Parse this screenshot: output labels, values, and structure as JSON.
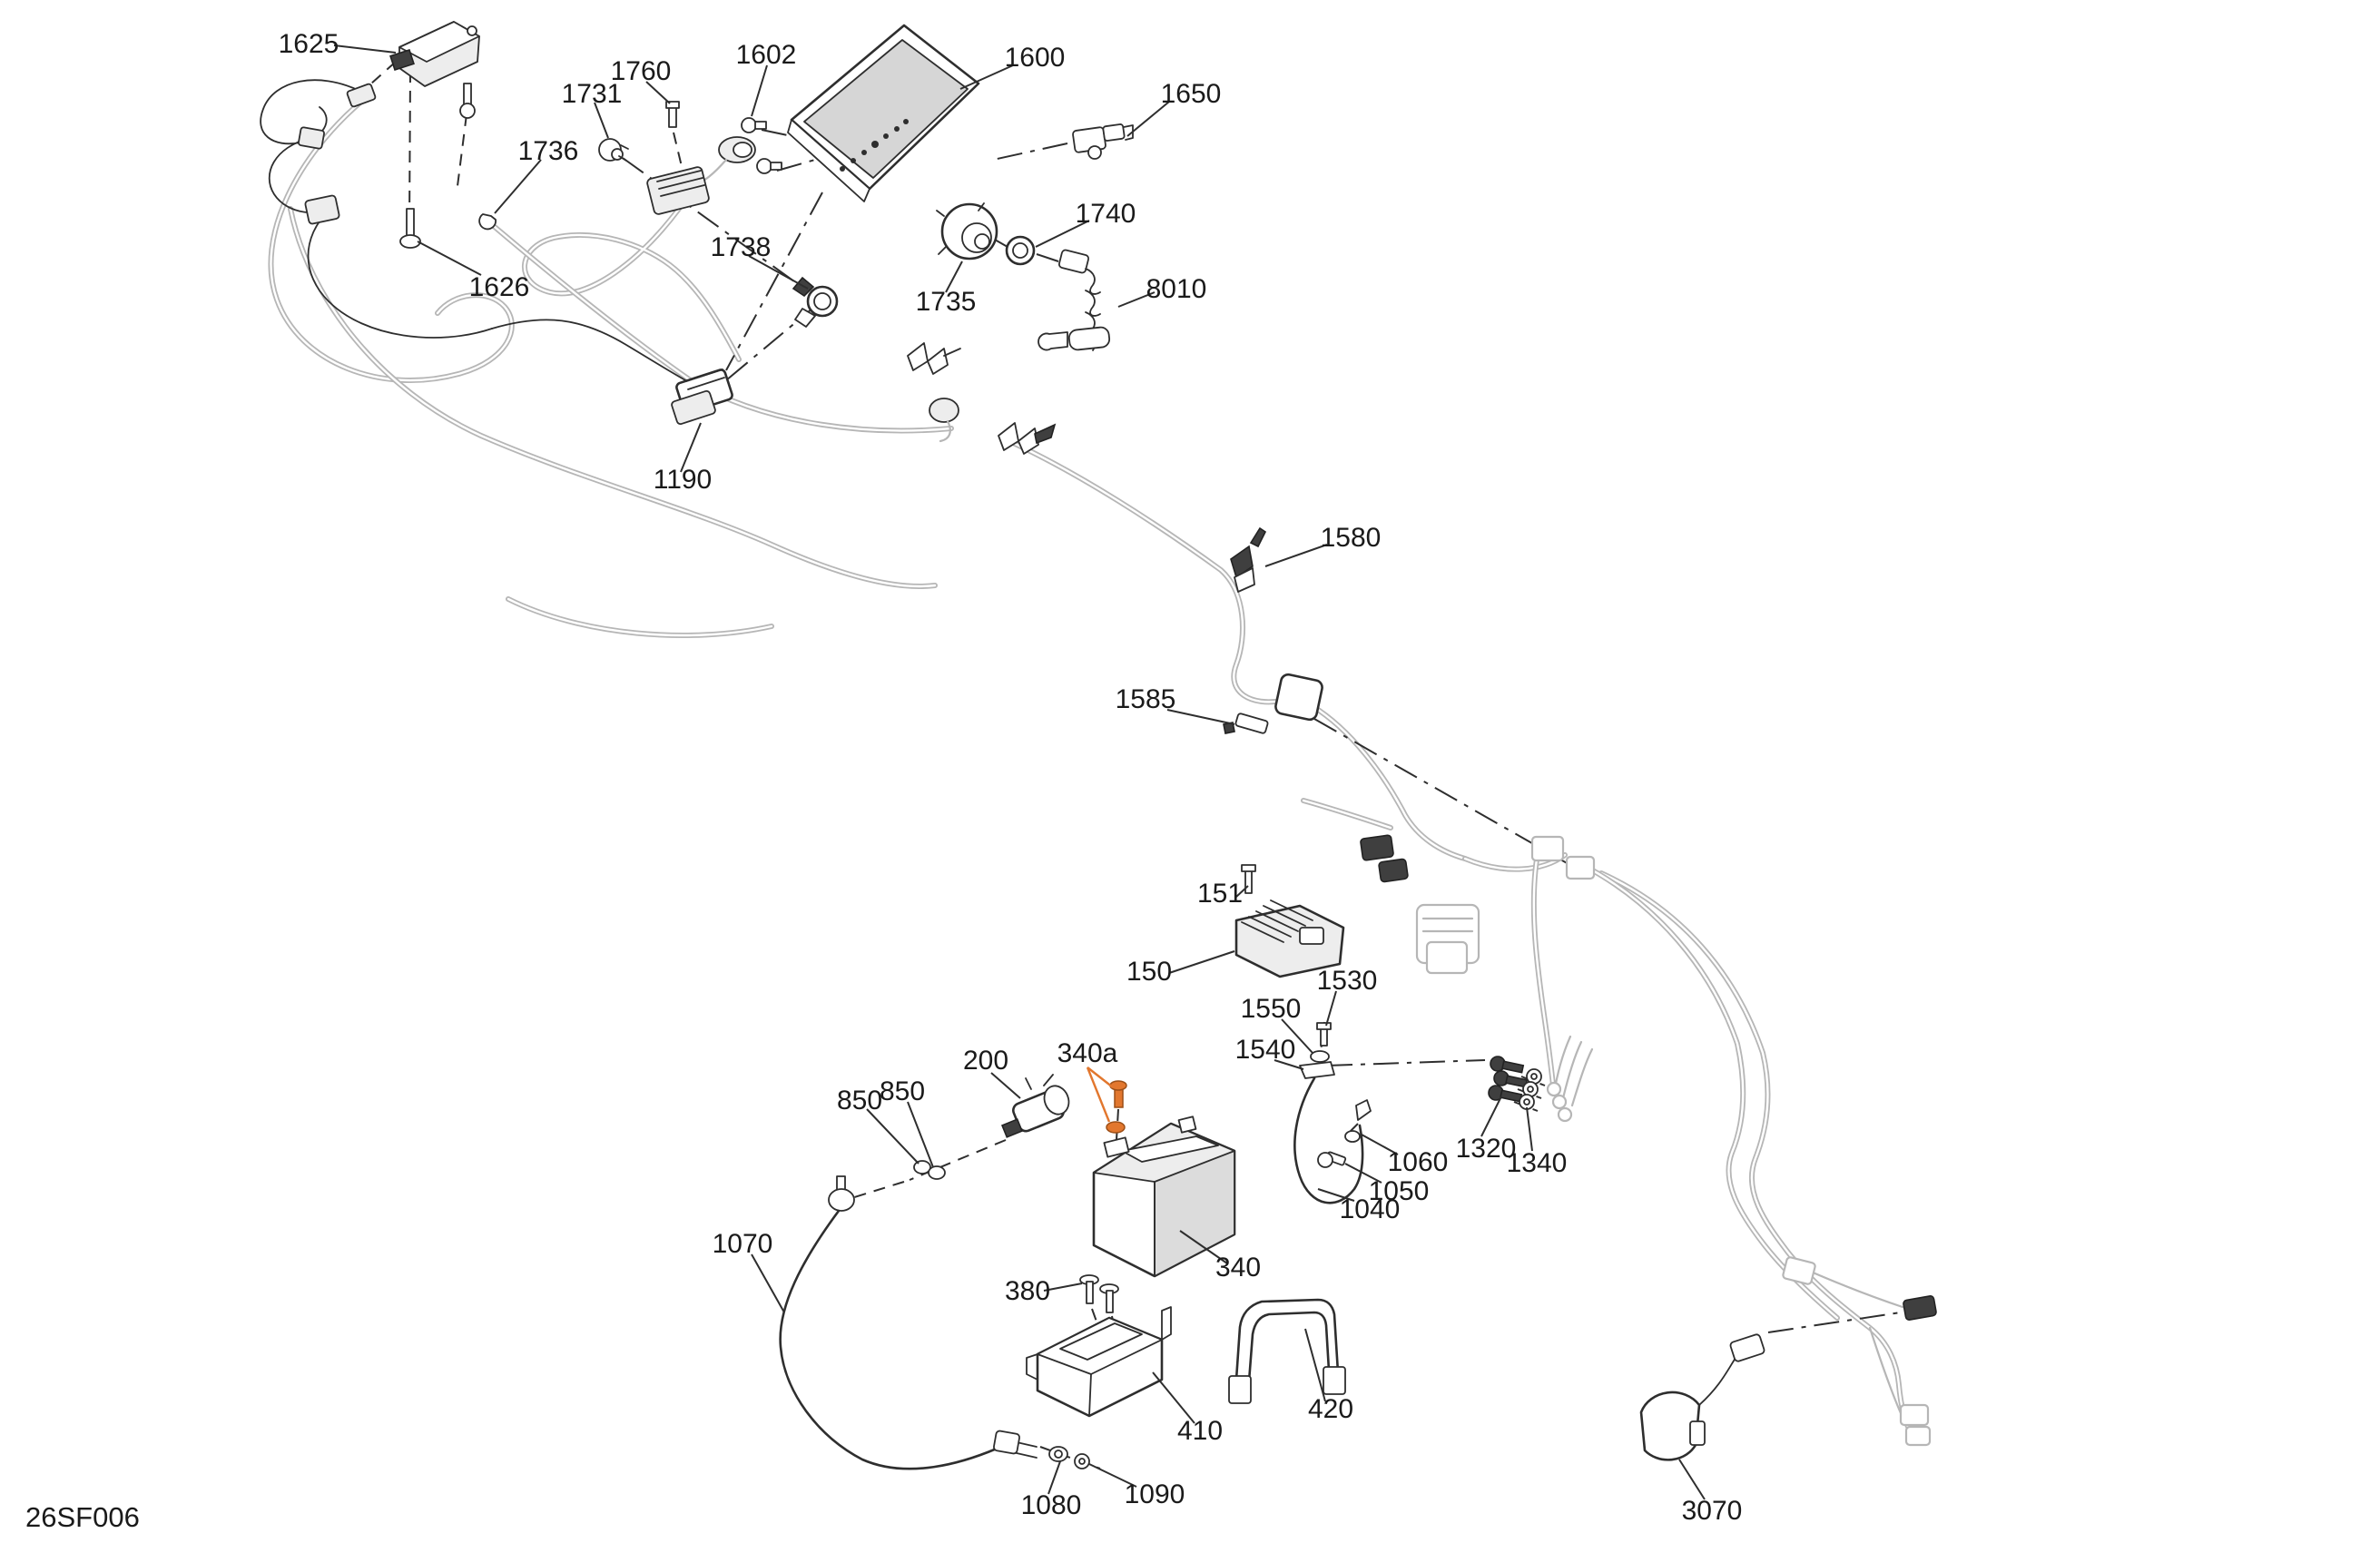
{
  "diagram": {
    "code": "26SF006",
    "colors": {
      "background": "#ffffff",
      "line": "#2e2e2e",
      "harness_light": "#b6b6b6",
      "screen_fill": "#d6d6d6",
      "battery_fill": "#dcdcdc",
      "accent_orange": "#e2772e"
    },
    "callouts": [
      {
        "text": "1625"
      },
      {
        "text": "1626"
      },
      {
        "text": "1736"
      },
      {
        "text": "1731"
      },
      {
        "text": "1760"
      },
      {
        "text": "1602"
      },
      {
        "text": "1600"
      },
      {
        "text": "1650"
      },
      {
        "text": "1738"
      },
      {
        "text": "1735"
      },
      {
        "text": "1740"
      },
      {
        "text": "8010"
      },
      {
        "text": "1190"
      },
      {
        "text": "1580"
      },
      {
        "text": "1585"
      },
      {
        "text": "151"
      },
      {
        "text": "150"
      },
      {
        "text": "1530"
      },
      {
        "text": "1550"
      },
      {
        "text": "1540"
      },
      {
        "text": "200"
      },
      {
        "text": "340a"
      },
      {
        "text": "850"
      },
      {
        "text": "850"
      },
      {
        "text": "1070"
      },
      {
        "text": "340"
      },
      {
        "text": "380"
      },
      {
        "text": "410"
      },
      {
        "text": "420"
      },
      {
        "text": "1060"
      },
      {
        "text": "1050"
      },
      {
        "text": "1040"
      },
      {
        "text": "1320"
      },
      {
        "text": "1340"
      },
      {
        "text": "1090"
      },
      {
        "text": "1080"
      },
      {
        "text": "3070"
      }
    ]
  }
}
